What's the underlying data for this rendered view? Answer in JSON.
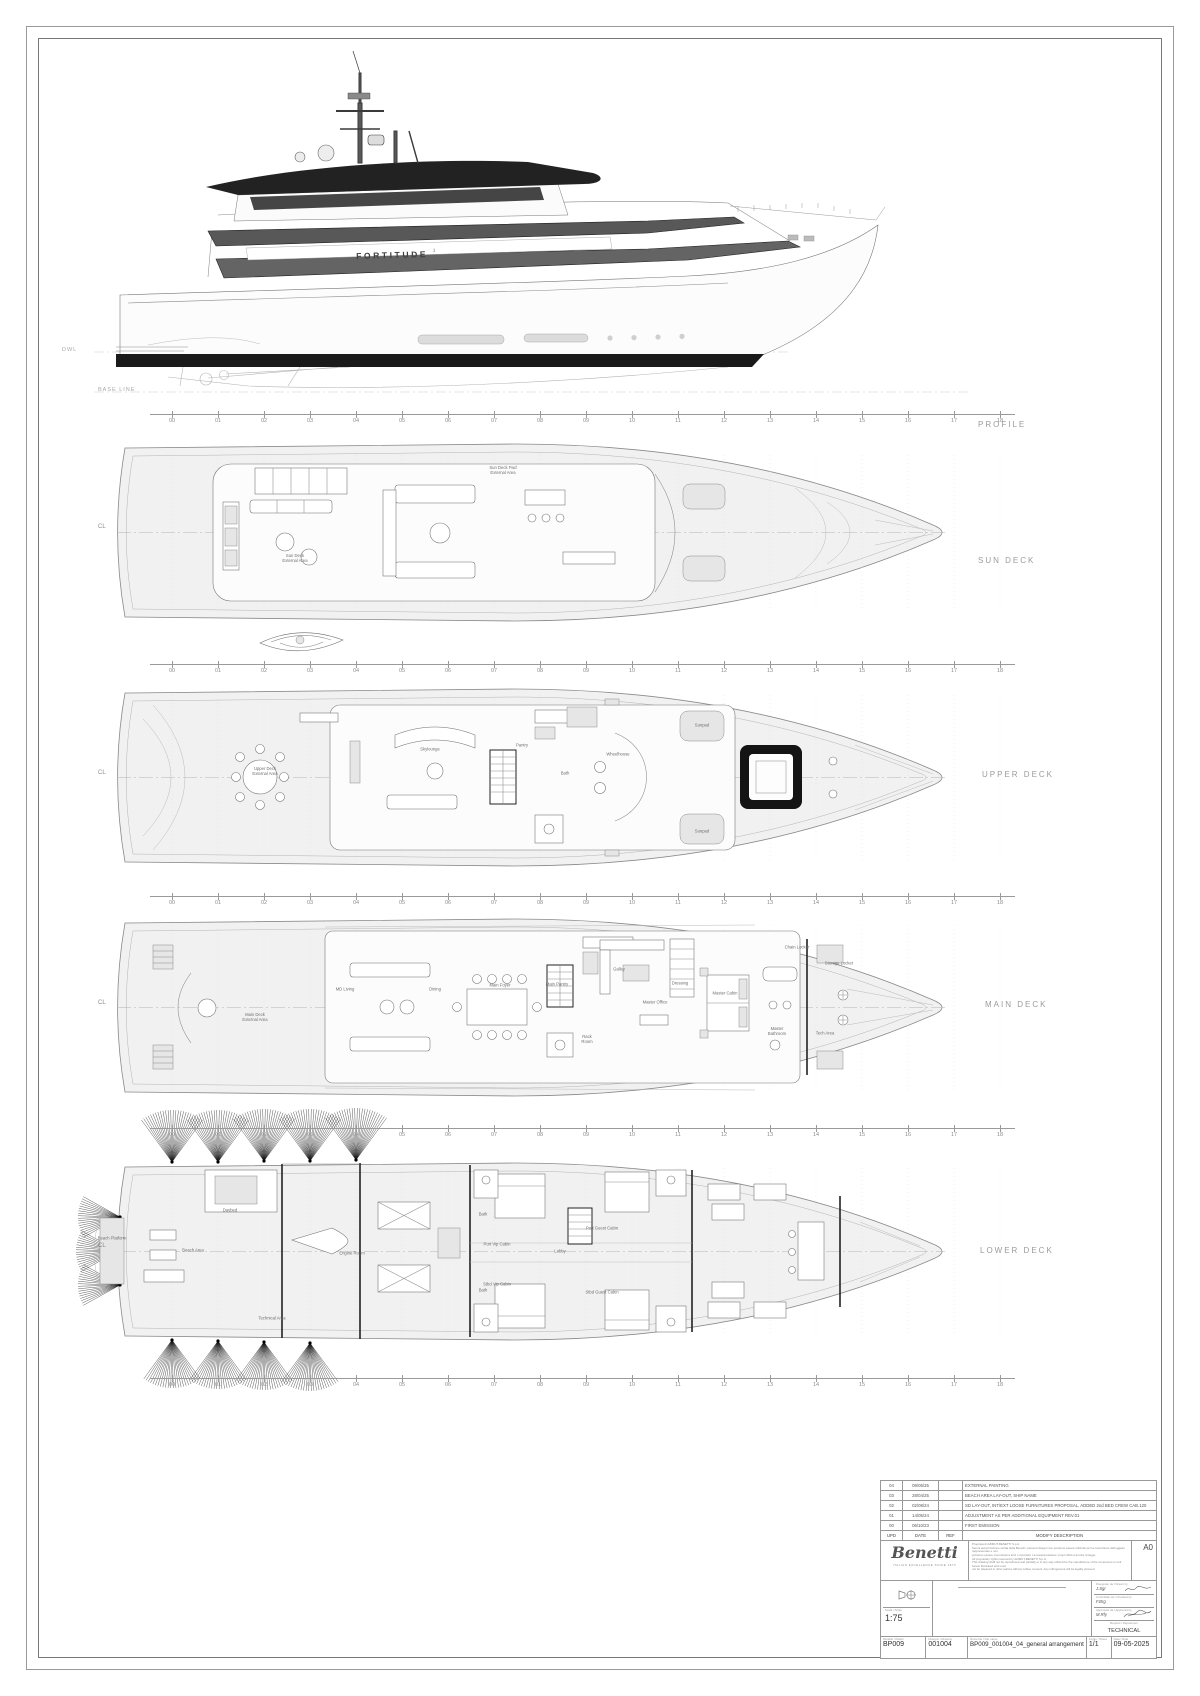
{
  "sheet_format": "A0",
  "ship": {
    "name": "FORTITUDE",
    "sup": "1"
  },
  "views": {
    "profile": "PROFILE",
    "sun": "SUN DECK",
    "upper": "UPPER DECK",
    "main": "MAIN DECK",
    "lower": "LOWER DECK"
  },
  "marks": {
    "cl": "CL",
    "dwl": "DWL",
    "baseline": "BASE LINE"
  },
  "frames": [
    "00",
    "01",
    "02",
    "03",
    "04",
    "05",
    "06",
    "07",
    "08",
    "09",
    "10",
    "11",
    "12",
    "13",
    "14",
    "15",
    "16",
    "17",
    "18"
  ],
  "decks": {
    "sun": {
      "labels": [
        {
          "t": "Sun Deck\nExternal Area",
          "x": 200,
          "y": 128
        },
        {
          "t": "Sun Deck Fwd\nExternal Area",
          "x": 408,
          "y": 40
        }
      ]
    },
    "upper": {
      "labels": [
        {
          "t": "Upper Deck\nExternal Area",
          "x": 170,
          "y": 96
        },
        {
          "t": "Skylounge",
          "x": 335,
          "y": 74
        },
        {
          "t": "Pantry",
          "x": 427,
          "y": 70
        },
        {
          "t": "Bath",
          "x": 470,
          "y": 98
        },
        {
          "t": "Wheelhouse",
          "x": 523,
          "y": 79
        },
        {
          "t": "Sunpad",
          "x": 607,
          "y": 50
        },
        {
          "t": "Sunpad",
          "x": 607,
          "y": 156
        }
      ]
    },
    "main": {
      "labels": [
        {
          "t": "Main Deck\nExternal Area",
          "x": 160,
          "y": 112
        },
        {
          "t": "MD Living",
          "x": 250,
          "y": 84
        },
        {
          "t": "Dining",
          "x": 340,
          "y": 84
        },
        {
          "t": "Main Foyer",
          "x": 405,
          "y": 80
        },
        {
          "t": "Main Pantry",
          "x": 462,
          "y": 79
        },
        {
          "t": "Galley",
          "x": 524,
          "y": 64
        },
        {
          "t": "Master Office",
          "x": 560,
          "y": 97
        },
        {
          "t": "Dressing",
          "x": 585,
          "y": 78
        },
        {
          "t": "Master Cabin",
          "x": 630,
          "y": 88
        },
        {
          "t": "Master\nBathroom",
          "x": 682,
          "y": 126
        },
        {
          "t": "Rack\nRoom",
          "x": 492,
          "y": 134
        },
        {
          "t": "Tech Area",
          "x": 730,
          "y": 128
        },
        {
          "t": "Storage Locker",
          "x": 744,
          "y": 58
        },
        {
          "t": "Chain Locker",
          "x": 702,
          "y": 42
        }
      ]
    },
    "lower": {
      "labels": [
        {
          "t": "Beach Platform",
          "x": 72,
          "y": 128
        },
        {
          "t": "Beach Area",
          "x": 153,
          "y": 140
        },
        {
          "t": "Daybed",
          "x": 190,
          "y": 100
        },
        {
          "t": "Engine Room",
          "x": 312,
          "y": 143
        },
        {
          "t": "Bath",
          "x": 443,
          "y": 104
        },
        {
          "t": "Port Vip Cabin",
          "x": 457,
          "y": 134
        },
        {
          "t": "Stbd Vip Cabin",
          "x": 457,
          "y": 174
        },
        {
          "t": "Bath",
          "x": 443,
          "y": 180
        },
        {
          "t": "Lobby",
          "x": 520,
          "y": 141
        },
        {
          "t": "Port Guest Cabin",
          "x": 562,
          "y": 118
        },
        {
          "t": "Stbd Guest Cabin",
          "x": 562,
          "y": 182
        },
        {
          "t": "Technical Area",
          "x": 232,
          "y": 208
        }
      ]
    }
  },
  "titleblock": {
    "revision_header": {
      "upd": "UPD",
      "date": "DATE",
      "ref": "REF",
      "desc": "MODIFY DESCRIPTION"
    },
    "revisions": [
      {
        "upd": "04",
        "date": "09/05/25",
        "ref": "",
        "desc": "EXTERNAL PAINTING"
      },
      {
        "upd": "03",
        "date": "28/04/25",
        "ref": "",
        "desc": "BEACH AREA LAY-OUT, SHIP NAME"
      },
      {
        "upd": "02",
        "date": "02/08/24",
        "ref": "",
        "desc": "SD LAY-OUT, INT/EXT LOOSE FURNITURES PROPOSAL, ADDED 2nd BED CREW CAB.120"
      },
      {
        "upd": "01",
        "date": "14/05/24",
        "ref": "",
        "desc": "ADJUSTMENT AS PER ADDITIONAL EQUIPMENT REV.01"
      },
      {
        "upd": "00",
        "date": "06/10/23",
        "ref": "",
        "desc": "FIRST EMISSION"
      }
    ],
    "brand": {
      "name": "Benetti",
      "tagline": "ITALIAN EXCELLENCE SINCE 1873"
    },
    "format": "A0",
    "disclaimer": [
      "Proprieta di AZIMUT-BENETTI S.p.A.",
      "Senza autorizzazione scritta della Benetti i presenti disegni non potranno essere utilizzati per la costruzione dell'oggetto rappresentato e non",
      "potranno essere comunicati a terzi o riprodotti. La societa tutelera i propri diritti a termini di legge.",
      "All proprietary rights reserved by AZIMUT-BENETTI S.p.A.",
      "This drawing shall not be reproduced and partially or in any way utilized for the manufacture of the component or unit herein illustrated and must",
      "not be released to other parties without written consent. Any infringement will be legally pursued."
    ],
    "scale_label": "Scala / Scale",
    "scale": "1:75",
    "sign": {
      "drawn_label": "Disegnato da / Drawn by",
      "drawn": "J.Sgr",
      "checked_label": "Controllato da / Checked by",
      "checked": "F.Brg",
      "approved_label": "Approvato da / Approved by",
      "approved": "M.Rfy",
      "dept_label": "Reparto / Department",
      "dept": "TECHNICAL"
    },
    "doc": {
      "model_label": "Modello / Model",
      "model": "BP009",
      "drawing_label": "Disegno / Drawing",
      "drawing": "001004",
      "file_label": "Nome file / File name",
      "file": "BP009_001004_04_general arrangement",
      "sheet_label": "Foglio / Sheet",
      "sheet": "1/1",
      "date_label": "Data / Date",
      "date": "09-05-2025"
    }
  }
}
